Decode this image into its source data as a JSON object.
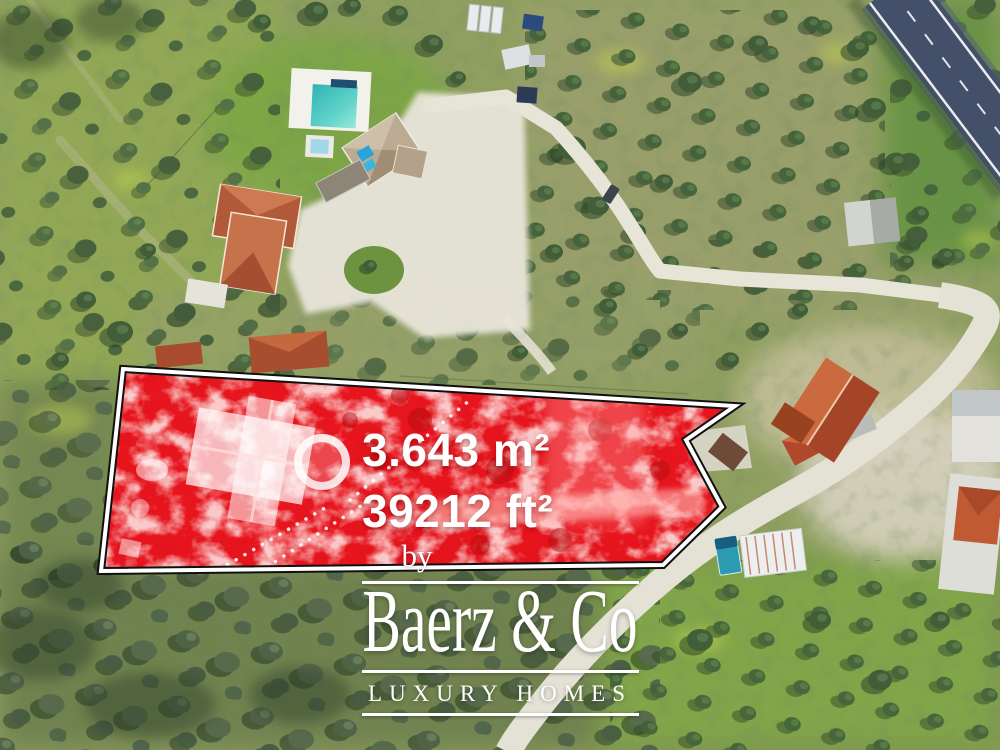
{
  "plot": {
    "area_m2": "3.643 m²",
    "area_ft2": "39212 ft²",
    "fill_color": "#e9111b",
    "outline_color": "#ffffff"
  },
  "branding": {
    "by_label": "by",
    "name": "Baerz & Co",
    "tagline": "LUXURY HOMES",
    "text_color": "#ffffff"
  }
}
